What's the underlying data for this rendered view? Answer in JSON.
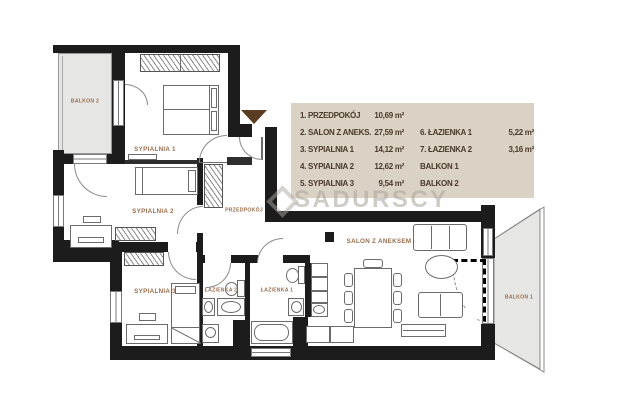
{
  "watermark": {
    "text": "SADURSCY"
  },
  "entrance_marker_color": "#5a3c21",
  "colors": {
    "wall": "#1c1c1c",
    "legend_bg": "#d9d2c5",
    "legend_text": "#4a392b",
    "room_label": "#9a6e4c",
    "balcony_fill": "#e6e6e4"
  },
  "rooms": {
    "balkon2": "BALKON 2",
    "sypialnia1": "SYPIALNIA 1",
    "sypialnia2": "SYPIALNIA 2",
    "sypialnia3": "SYPIALNIA 3",
    "przedpokoj": "PRZEDPOKÓJ",
    "lazienka2": "ŁAZIENKA 2",
    "lazienka1": "ŁAZIENKA 1",
    "salon": "SALON Z ANEKSEM",
    "balkon1": "BALKON 1"
  },
  "legend": {
    "rows": [
      {
        "c1": "1. PRZEDPOKÓJ",
        "v1": "10,69 m²",
        "c2": "",
        "v2": ""
      },
      {
        "c1": "2. SALON Z ANEKS.",
        "v1": "27,59 m²",
        "c2": "6. ŁAZIENKA 1",
        "v2": "5,22 m²"
      },
      {
        "c1": "3. SYPIALNIA 1",
        "v1": "14,12 m²",
        "c2": "7. ŁAZIENKA 2",
        "v2": "3,16 m²"
      },
      {
        "c1": "4. SYPIALNIA 2",
        "v1": "12,62 m²",
        "c2": "BALKON 1",
        "v2": ""
      },
      {
        "c1": "5. SYPIALNIA 3",
        "v1": "9,54 m²",
        "c2": "BALKON 2",
        "v2": ""
      }
    ]
  }
}
